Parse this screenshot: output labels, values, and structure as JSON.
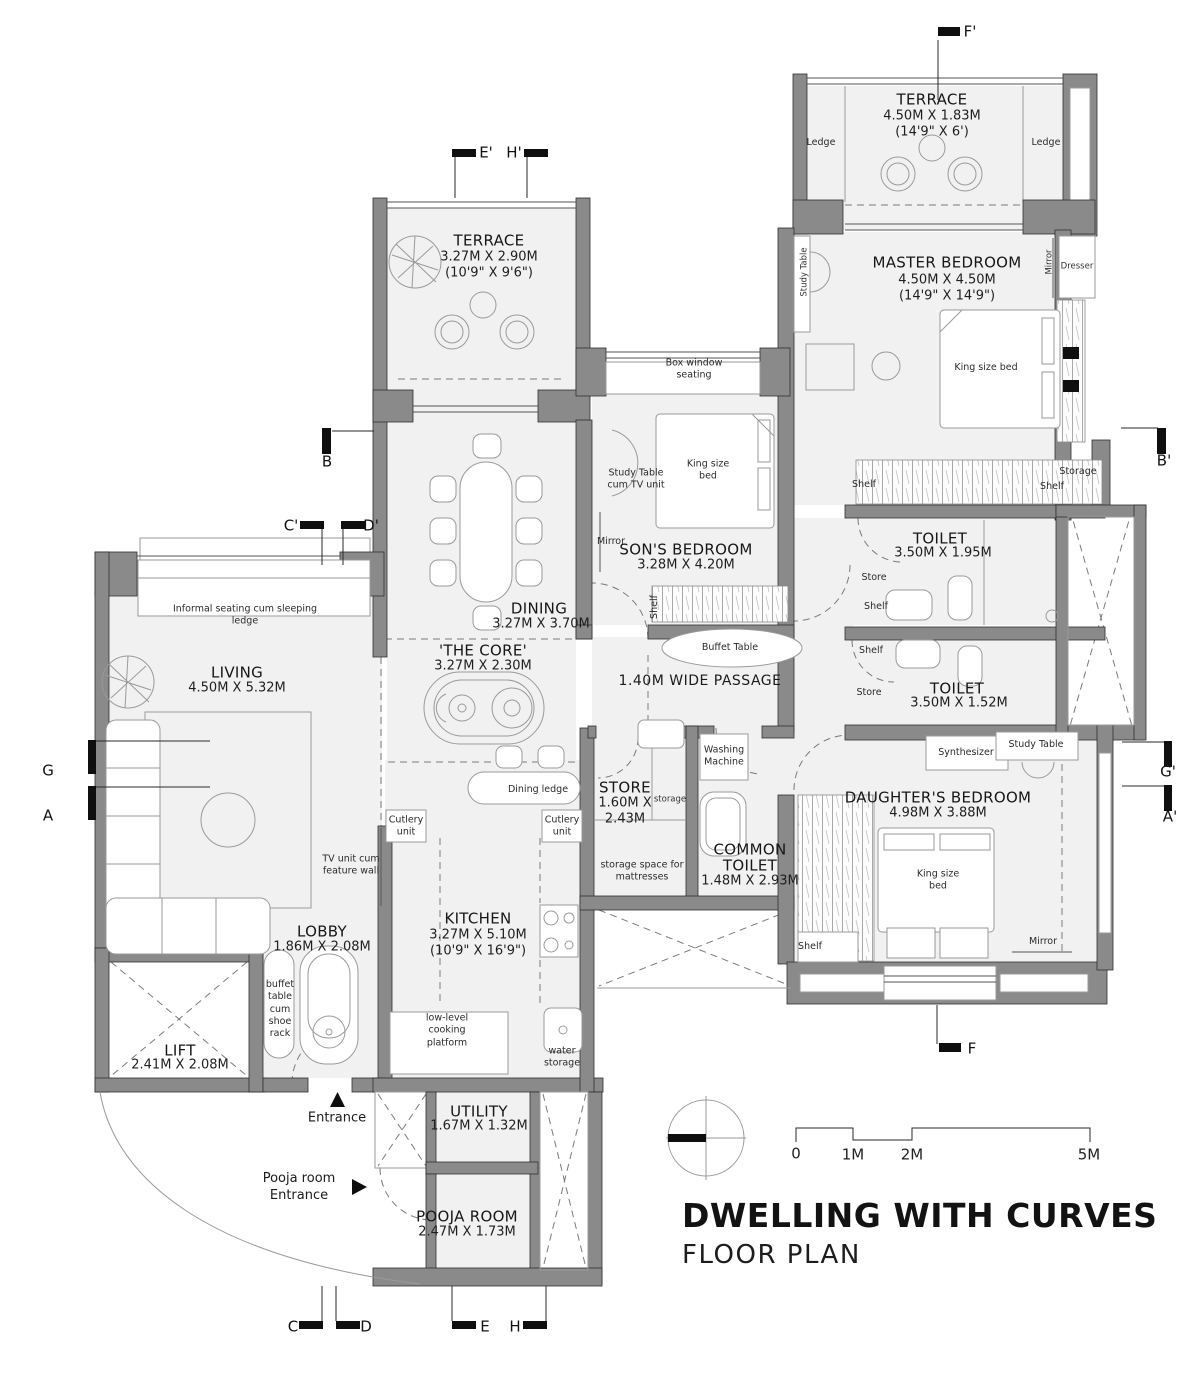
{
  "colors": {
    "wall": "#8a8a8a",
    "wall_edge": "#2f2f2f",
    "room_fill": "#f1f1f1",
    "line": "#9a9a9a",
    "dark_line": "#555555",
    "text": "#1b1b1b"
  },
  "title_block": {
    "title": "DWELLING WITH CURVES",
    "subtitle": "FLOOR PLAN"
  },
  "scale_bar": {
    "t0": "0",
    "t1": "1M",
    "t2": "2M",
    "t5": "5M"
  },
  "rooms": {
    "terrace_master": {
      "name": "TERRACE",
      "dims_m": "4.50M X 1.83M",
      "dims_ft": "(14'9\" X 6')"
    },
    "master_bedroom": {
      "name": "MASTER BEDROOM",
      "dims_m": "4.50M X 4.50M",
      "dims_ft": "(14'9\" X 14'9\")"
    },
    "terrace_dining": {
      "name": "TERRACE",
      "dims_m": "3.27M X 2.90M",
      "dims_ft": "(10'9\" X 9'6\")"
    },
    "sons_bedroom": {
      "name": "SON'S BEDROOM",
      "dims_m": "3.28M X 4.20M"
    },
    "dining": {
      "name": "DINING",
      "dims_m": "3.27M X 3.70M"
    },
    "core": {
      "name": "'THE CORE'",
      "dims_m": "3.27M X 2.30M"
    },
    "passage": {
      "name": "1.40M WIDE PASSAGE"
    },
    "living": {
      "name": "LIVING",
      "dims_m": "4.50M X 5.32M"
    },
    "toilet_master": {
      "name": "TOILET",
      "dims_m": "3.50M X 1.95M"
    },
    "toilet_sons": {
      "name": "TOILET",
      "dims_m": "3.50M X 1.52M"
    },
    "daughters_bedroom": {
      "name": "DAUGHTER'S BEDROOM",
      "dims_m": "4.98M X 3.88M"
    },
    "store": {
      "name": "STORE",
      "dims_l1": "1.60M X",
      "dims_l2": "2.43M"
    },
    "common_toilet": {
      "name_l1": "COMMON",
      "name_l2": "TOILET",
      "dims_m": "1.48M X 2.93M"
    },
    "lobby": {
      "name": "LOBBY",
      "dims_m": "1.86M X 2.08M"
    },
    "kitchen": {
      "name": "KITCHEN",
      "dims_m": "3.27M X 5.10M",
      "dims_ft": "(10'9\" X 16'9\")"
    },
    "lift": {
      "name": "LIFT",
      "dims_m": "2.41M X 2.08M"
    },
    "utility": {
      "name": "UTILITY",
      "dims_m": "1.67M X 1.32M"
    },
    "pooja_room": {
      "name": "POOJA ROOM",
      "dims_m": "2.47M X 1.73M"
    }
  },
  "annotations": {
    "ledge": "Ledge",
    "study_table": "Study Table",
    "mirror": "Mirror",
    "dresser": "Dresser",
    "king_size_bed": "King size bed",
    "box_window_seating": "Box window seating",
    "study_table_cum_tv_unit": "Study Table cum TV unit",
    "shelf": "Shelf",
    "storage_cap": "Storage",
    "store_cap": "Store",
    "storage": "storage",
    "buffet_table": "Buffet Table",
    "informal_seating": "Informal seating cum sleeping ledge",
    "synthesizer": "Synthesizer",
    "washing_machine": "Washing Machine",
    "storage_space_for_mattresses": "storage space for mattresses",
    "cutlery_unit": "Cutlery unit",
    "tv_unit_cum_feature_wall": "TV unit cum feature wall",
    "dining_ledge": "Dining ledge",
    "buffet_table_cum_shoe_rack": "buffet table cum shoe rack",
    "low_level_cooking_platform": "low-level cooking platform",
    "water_storage": "water storage",
    "entrance": "Entrance",
    "pooja_room_entrance": "Pooja room Entrance"
  },
  "section_markers": {
    "a": "A",
    "a_p": "A'",
    "b": "B",
    "b_p": "B'",
    "c": "C",
    "c_p": "C'",
    "d": "D",
    "d_p": "D'",
    "e": "E",
    "e_p": "E'",
    "f": "F",
    "f_p": "F'",
    "g": "G",
    "g_p": "G'",
    "h": "H",
    "h_p": "H'"
  }
}
